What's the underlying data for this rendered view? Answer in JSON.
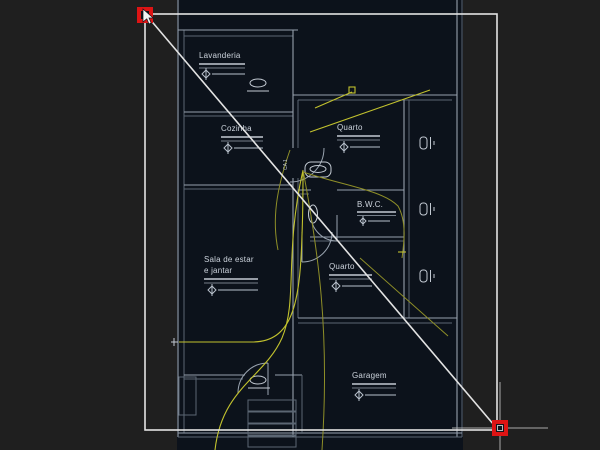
{
  "app": {
    "description": "CAD floor-plan drawing canvas (dark theme) with a selected diagonal line and zoom-window rectangle, hot grips shown in red",
    "canvas_background": "#1f1f1f",
    "plan_fill": "#0c121b"
  },
  "colors": {
    "wall": "#96a0ac",
    "wall_dim": "#5b6673",
    "wiring_yellow": "#c2c22e",
    "selection_white": "#e3e3e3",
    "grip_red": "#dd1414",
    "grip_core": "#10151c",
    "crosshair": "#a9a9a9",
    "label_text": "#ccd3dc"
  },
  "rooms": [
    {
      "label": "Lavanderia"
    },
    {
      "label": "Cozinha"
    },
    {
      "label": "Quarto"
    },
    {
      "label": "B.W.C."
    },
    {
      "label": "Quarto"
    },
    {
      "label": "Sala de estar",
      "label2": "e jantar"
    },
    {
      "label": "Garagem"
    }
  ],
  "annotations": {
    "door_tag": "CA 1"
  },
  "selection": {
    "grip_count": 2,
    "line_start": {
      "x": 148,
      "y": 17
    },
    "line_end": {
      "x": 494,
      "y": 425
    },
    "window_rect": {
      "x1": 145,
      "y1": 14,
      "x2": 497,
      "y2": 430
    },
    "crosshair_position": {
      "x": 500,
      "y": 428
    }
  }
}
